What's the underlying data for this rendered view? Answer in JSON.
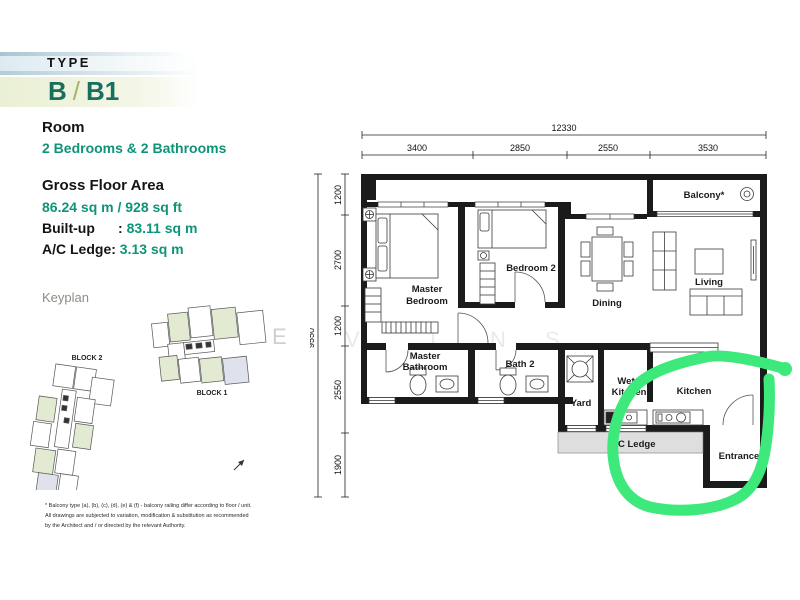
{
  "header": {
    "type_label": "TYPE",
    "unit_code_left": "B",
    "unit_code_sep": "/",
    "unit_code_right": "B1"
  },
  "info": {
    "room_label": "Room",
    "room_value": "2 Bedrooms & 2 Bathrooms",
    "gfa_label": "Gross Floor Area",
    "gfa_value": "86.24 sq m / 928 sq ft",
    "builtup_label": "Built-up",
    "builtup_sep": ":",
    "builtup_value": "83.11 sq m",
    "acledge_label": "A/C Ledge:",
    "acledge_value": "3.13 sq m"
  },
  "keyplan": {
    "title": "Keyplan",
    "block1": "BLOCK 1",
    "block2": "BLOCK 2"
  },
  "plan": {
    "rooms": {
      "master_bedroom": [
        "Master",
        "Bedroom"
      ],
      "bedroom2": "Bedroom 2",
      "dining": "Dining",
      "living": "Living",
      "balcony": "Balcony*",
      "master_bath": [
        "Master",
        "Bathroom"
      ],
      "bath2": "Bath 2",
      "yard": "Yard",
      "wet_kitchen": [
        "Wet",
        "Kitchen"
      ],
      "kitchen": "Kitchen",
      "ac_ledge": "A/C Ledge",
      "entrance": "Entrance"
    },
    "dims": {
      "total_w": "12330",
      "top": [
        "3400",
        "2850",
        "2550",
        "3530"
      ],
      "total_h": "9550",
      "left": [
        "1200",
        "2700",
        "1200",
        "2550",
        "1900"
      ]
    },
    "watermark": [
      "E",
      "V",
      "I",
      "N",
      "S"
    ]
  },
  "footnote": {
    "line1": "* Balcony type (a), (b), (c), (d), (e) & (f) - balcony railing differ according to floor / unit.",
    "line2": "All drawings are subjected to variation, modification & substitution as recommended",
    "line3": "by the Architect and / or directed by the relevant Authority."
  },
  "colors": {
    "accent_green_text": "#0e9478",
    "teal_heading": "#17705f",
    "annotation_green": "#3ee97c",
    "wall_black": "#1b1b1b",
    "ac_ledge_fill": "#dedede"
  }
}
